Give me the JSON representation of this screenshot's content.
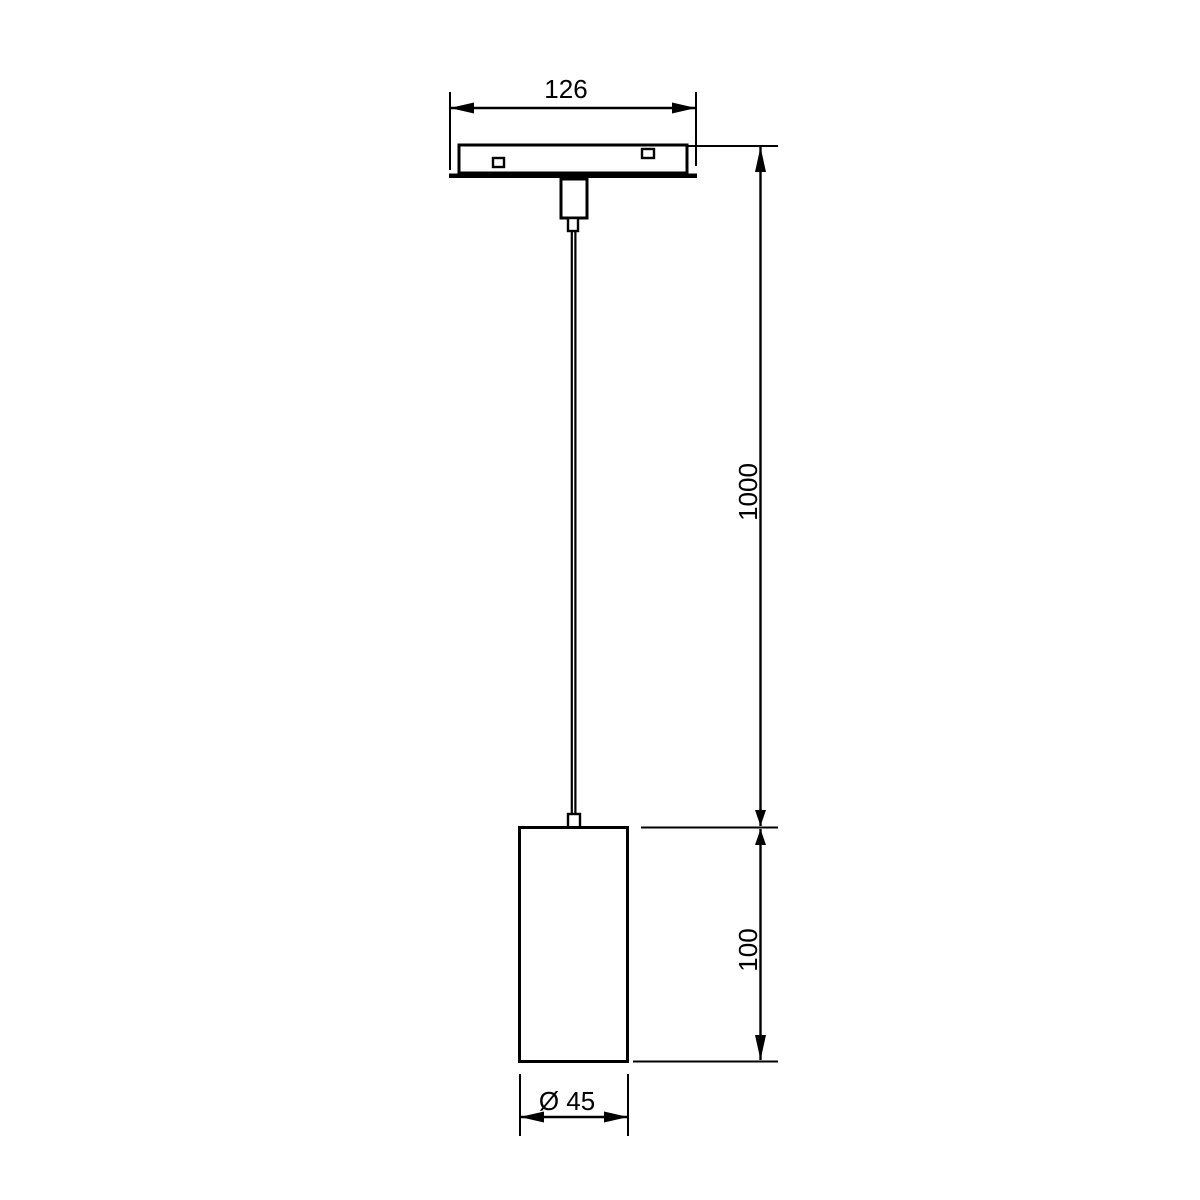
{
  "drawing": {
    "background_color": "#ffffff",
    "line_color": "#000000",
    "labels": {
      "track_width": "126",
      "suspension_length": "1000",
      "body_height": "100",
      "body_diameter": "Ø 45"
    }
  }
}
